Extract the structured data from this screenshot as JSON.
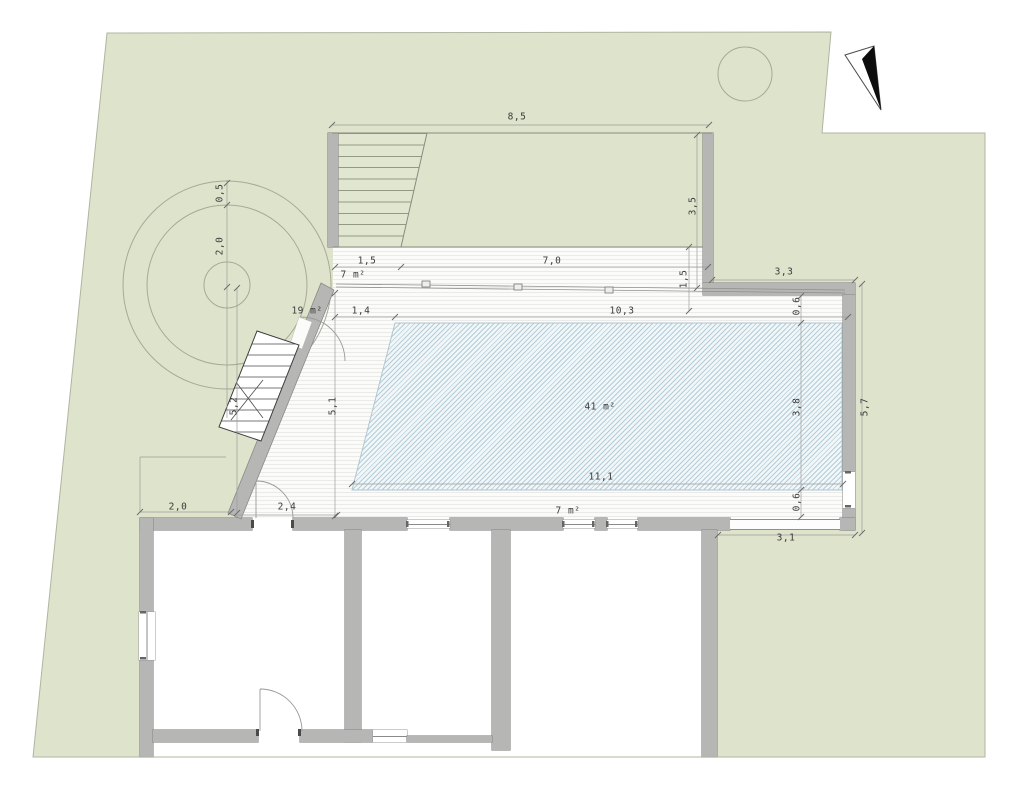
{
  "plan": {
    "areas": {
      "pool": "41 m²",
      "terrace": "19 m²",
      "upper_deck": "7 m²",
      "lower_deck": "7 m²"
    },
    "dimensions": {
      "top_width": "8,5",
      "right_stair_height": "3,5",
      "upper_deck_step": "1,5",
      "upper_deck_width": "7,0",
      "right_deck_depth": "1,5",
      "wing_top_width": "3,3",
      "pool_inset_left": "1,4",
      "pool_top_width": "10,3",
      "pool_margin_top": "0,6",
      "tree_ring_offset": "0,5",
      "tree_canopy_radius": "2,0",
      "pool_depth": "3,8",
      "right_side_length": "5,7",
      "terrace_left_length": "5,2",
      "terrace_inner_length": "5,1",
      "pool_bottom_width": "11,1",
      "pool_margin_bottom": "0,6",
      "house_left_setback": "2,0",
      "terrace_door_width": "2,4",
      "wing_bottom_width": "3,1"
    }
  }
}
